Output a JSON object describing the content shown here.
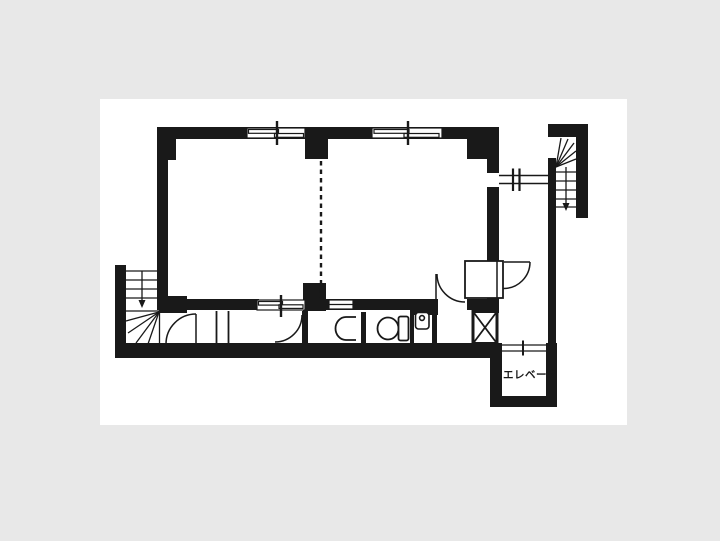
{
  "colors": {
    "background": "#e8e8e8",
    "paper": "#ffffff",
    "ink": "#191919"
  },
  "floorplan": {
    "labels": {
      "elevator": "エレベータ"
    },
    "symbols": [
      {
        "name": "staircase-upper-right",
        "type": "winder-stairs-down-arrow"
      },
      {
        "name": "staircase-lower-left",
        "type": "winder-stairs-down-arrow"
      },
      {
        "name": "elevator-shaft",
        "label": "エレベータ"
      },
      {
        "name": "duct-shaft",
        "type": "x-crossed-box"
      },
      {
        "name": "toilet",
        "type": "wc-bowl-with-tank"
      },
      {
        "name": "urinal",
        "type": "wall-urinal"
      },
      {
        "name": "wash-basin",
        "type": "basin-with-faucet"
      },
      {
        "name": "sliding-windows",
        "count": 4
      },
      {
        "name": "swing-doors",
        "count": 4
      },
      {
        "name": "room-partition",
        "type": "dashed-line"
      }
    ]
  }
}
